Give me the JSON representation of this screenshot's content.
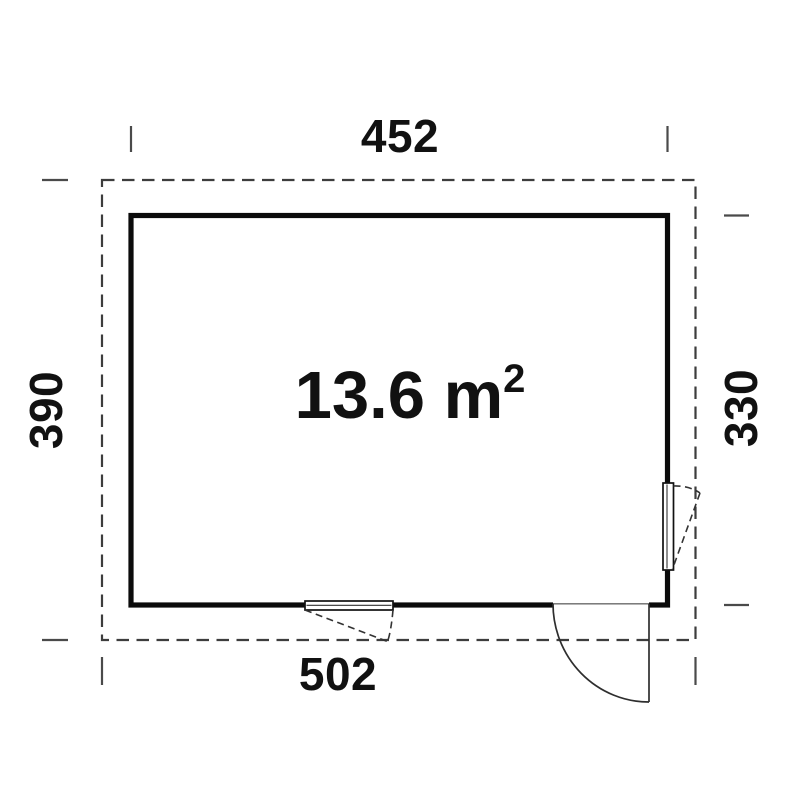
{
  "floor_plan": {
    "area_label": {
      "text": "13.6 m",
      "superscript": "2"
    },
    "dimensions": {
      "top_width": "452",
      "left_depth": "390",
      "right_depth": "330",
      "bottom_width": "502"
    },
    "colors": {
      "background": "#ffffff",
      "wall": "#0b0b0b",
      "overhang_dash": "#3d3d3d",
      "tick": "#4a4a4a",
      "text": "#111111",
      "door_swing": "#2e2e2e"
    },
    "features": {
      "door": "entrance-door",
      "window_right": "side-window",
      "window_bottom": "front-window"
    }
  }
}
